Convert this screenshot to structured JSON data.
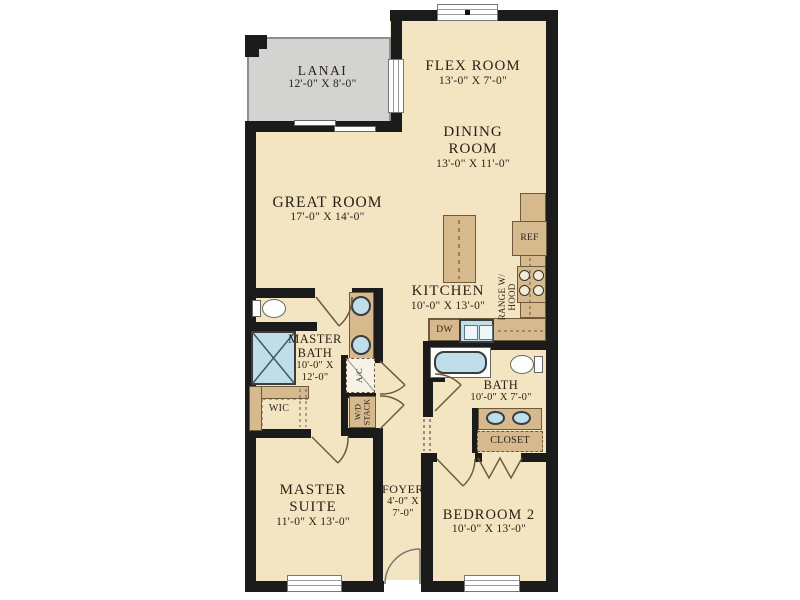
{
  "title": "Floor plan",
  "colors": {
    "wall": "#1b1b1b",
    "floor": "#f3e5c1",
    "lanai": "#d3d3d1",
    "counter": "#d6ba8e",
    "counterline": "#6d5a3c",
    "water": "#bedee9",
    "ink": "#2b2118",
    "winline": "#9a9a9a"
  },
  "rooms": {
    "lanai": {
      "name": "LANAI",
      "dims": "12'-0\" X 8'-0\""
    },
    "flex": {
      "name": "FLEX ROOM",
      "dims": "13'-0\" X 7'-0\""
    },
    "dining": {
      "name1": "DINING",
      "name2": "ROOM",
      "dims": "13'-0\" X 11'-0\""
    },
    "great": {
      "name": "GREAT ROOM",
      "dims": "17'-0\" X 14'-0\""
    },
    "kitchen": {
      "name": "KITCHEN",
      "dims": "10'-0\" X 13'-0\""
    },
    "master_bath": {
      "name1": "MASTER",
      "name2": "BATH",
      "dims1": "10'-0\" X",
      "dims2": "12'-0\""
    },
    "bath": {
      "name": "BATH",
      "dims": "10'-0\" X 7'-0\""
    },
    "master_suite": {
      "name1": "MASTER",
      "name2": "SUITE",
      "dims": "11'-0\" X 13'-0\""
    },
    "foyer": {
      "name": "FOYER",
      "dims1": "4'-0\" X",
      "dims2": "7'-0\""
    },
    "bedroom2": {
      "name": "BEDROOM 2",
      "dims": "10'-0\" X 13'-0\""
    }
  },
  "fixtures": {
    "ref": "REF",
    "dw": "DW",
    "range1": "RANGE W/",
    "range2": "HOOD",
    "ac": "A/C",
    "wd1": "W/D",
    "wd2": "STACK",
    "wic": "WIC",
    "closet": "CLOSET"
  }
}
